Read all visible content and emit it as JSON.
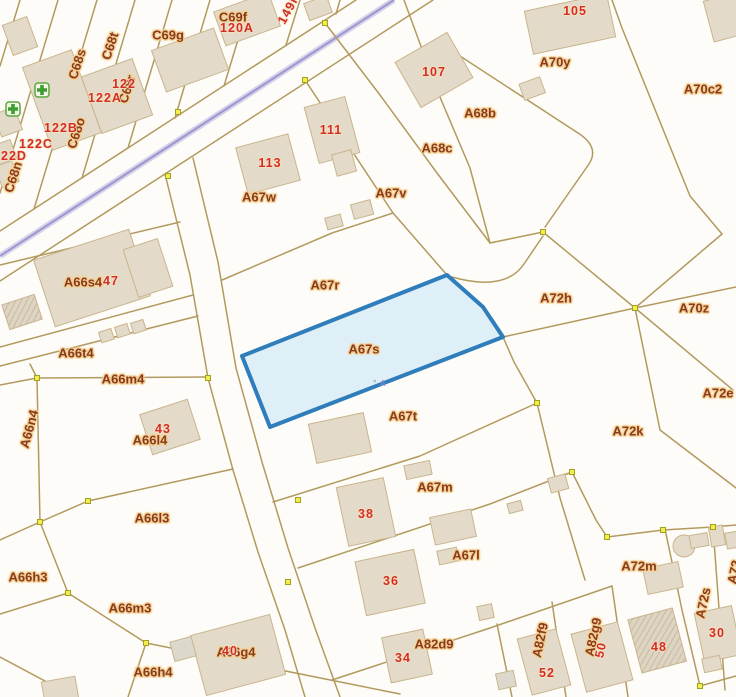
{
  "map": {
    "title": "cadastral-parcel-map",
    "colors": {
      "bg": "#fdfcf8",
      "boundary": "#b29a5f",
      "building_fill": "#e3dac9",
      "building_stroke": "#c9b58d",
      "road": "#a198cf",
      "node": "#f0ee4a",
      "label": "#8a3a1c",
      "number": "#d22d26",
      "halo": "#f3cf92"
    },
    "highlight": {
      "parcel": "A67s",
      "fill": "#d9ecf8",
      "stroke": "#2f7dba"
    },
    "parcel_labels": [
      {
        "text": "C69f",
        "x": 233,
        "y": 17
      },
      {
        "text": "C69g",
        "x": 168,
        "y": 35
      },
      {
        "text": "C68t",
        "x": 110,
        "y": 46,
        "rot": -72
      },
      {
        "text": "C68s",
        "x": 77,
        "y": 64,
        "rot": -72
      },
      {
        "text": "C68r",
        "x": 127,
        "y": 89,
        "rot": -72
      },
      {
        "text": "C68o",
        "x": 76,
        "y": 133,
        "rot": -72
      },
      {
        "text": "C68n",
        "x": 13,
        "y": 177,
        "rot": -72
      },
      {
        "text": "A70y",
        "x": 555,
        "y": 62
      },
      {
        "text": "A70c2",
        "x": 703,
        "y": 89
      },
      {
        "text": "A68b",
        "x": 480,
        "y": 113
      },
      {
        "text": "A68c",
        "x": 437,
        "y": 148
      },
      {
        "text": "A67v",
        "x": 391,
        "y": 193
      },
      {
        "text": "A67w",
        "x": 259,
        "y": 197
      },
      {
        "text": "A67r",
        "x": 325,
        "y": 285
      },
      {
        "text": "A72h",
        "x": 556,
        "y": 298
      },
      {
        "text": "A70z",
        "x": 694,
        "y": 308
      },
      {
        "text": "A66s4",
        "x": 83,
        "y": 282
      },
      {
        "text": "A66t4",
        "x": 76,
        "y": 353
      },
      {
        "text": "A66m4",
        "x": 123,
        "y": 379
      },
      {
        "text": "A66n4",
        "x": 29,
        "y": 429,
        "rot": -75
      },
      {
        "text": "A66l4",
        "x": 150,
        "y": 440
      },
      {
        "text": "A67s",
        "x": 364,
        "y": 349
      },
      {
        "text": "A67t",
        "x": 403,
        "y": 416
      },
      {
        "text": "A72e",
        "x": 718,
        "y": 393
      },
      {
        "text": "A72k",
        "x": 628,
        "y": 431
      },
      {
        "text": "A67m",
        "x": 435,
        "y": 487
      },
      {
        "text": "A66l3",
        "x": 152,
        "y": 518
      },
      {
        "text": "A67l",
        "x": 466,
        "y": 555
      },
      {
        "text": "A66h3",
        "x": 28,
        "y": 577
      },
      {
        "text": "A72m",
        "x": 639,
        "y": 566
      },
      {
        "text": "A66m3",
        "x": 130,
        "y": 608
      },
      {
        "text": "A72s",
        "x": 703,
        "y": 603,
        "rot": -78
      },
      {
        "text": "A72",
        "x": 734,
        "y": 572,
        "rot": -78
      },
      {
        "text": "A82d9",
        "x": 434,
        "y": 644
      },
      {
        "text": "A82f9",
        "x": 540,
        "y": 640,
        "rot": -78
      },
      {
        "text": "A82g9",
        "x": 593,
        "y": 637,
        "rot": -78
      },
      {
        "text": "A66g4",
        "x": 236,
        "y": 652
      },
      {
        "text": "A66h4",
        "x": 153,
        "y": 672
      }
    ],
    "house_numbers": [
      {
        "text": "105",
        "x": 575,
        "y": 11
      },
      {
        "text": "107",
        "x": 434,
        "y": 72
      },
      {
        "text": "111",
        "x": 331,
        "y": 130
      },
      {
        "text": "113",
        "x": 270,
        "y": 163
      },
      {
        "text": "120A",
        "x": 237,
        "y": 28
      },
      {
        "text": "122",
        "x": 124,
        "y": 84
      },
      {
        "text": "122A",
        "x": 105,
        "y": 98
      },
      {
        "text": "122B",
        "x": 61,
        "y": 128
      },
      {
        "text": "122C",
        "x": 36,
        "y": 144
      },
      {
        "text": "122D",
        "x": 10,
        "y": 156
      },
      {
        "text": "149h",
        "x": 289,
        "y": 9,
        "rot": -62
      },
      {
        "text": "47",
        "x": 111,
        "y": 281
      },
      {
        "text": "43",
        "x": 163,
        "y": 429
      },
      {
        "text": "38",
        "x": 366,
        "y": 514
      },
      {
        "text": "36",
        "x": 391,
        "y": 581
      },
      {
        "text": "34",
        "x": 403,
        "y": 658
      },
      {
        "text": "40",
        "x": 230,
        "y": 651
      },
      {
        "text": "52",
        "x": 547,
        "y": 673
      },
      {
        "text": "50",
        "x": 601,
        "y": 650,
        "rot": -78
      },
      {
        "text": "48",
        "x": 659,
        "y": 647
      },
      {
        "text": "30",
        "x": 717,
        "y": 633
      }
    ],
    "watermark": {
      "text": "˟ A",
      "x": 380,
      "y": 384
    },
    "poi_icons": [
      {
        "name": "medical-cross-marker",
        "x": 42,
        "y": 90
      },
      {
        "name": "medical-cross-marker",
        "x": 13,
        "y": 109
      }
    ]
  }
}
